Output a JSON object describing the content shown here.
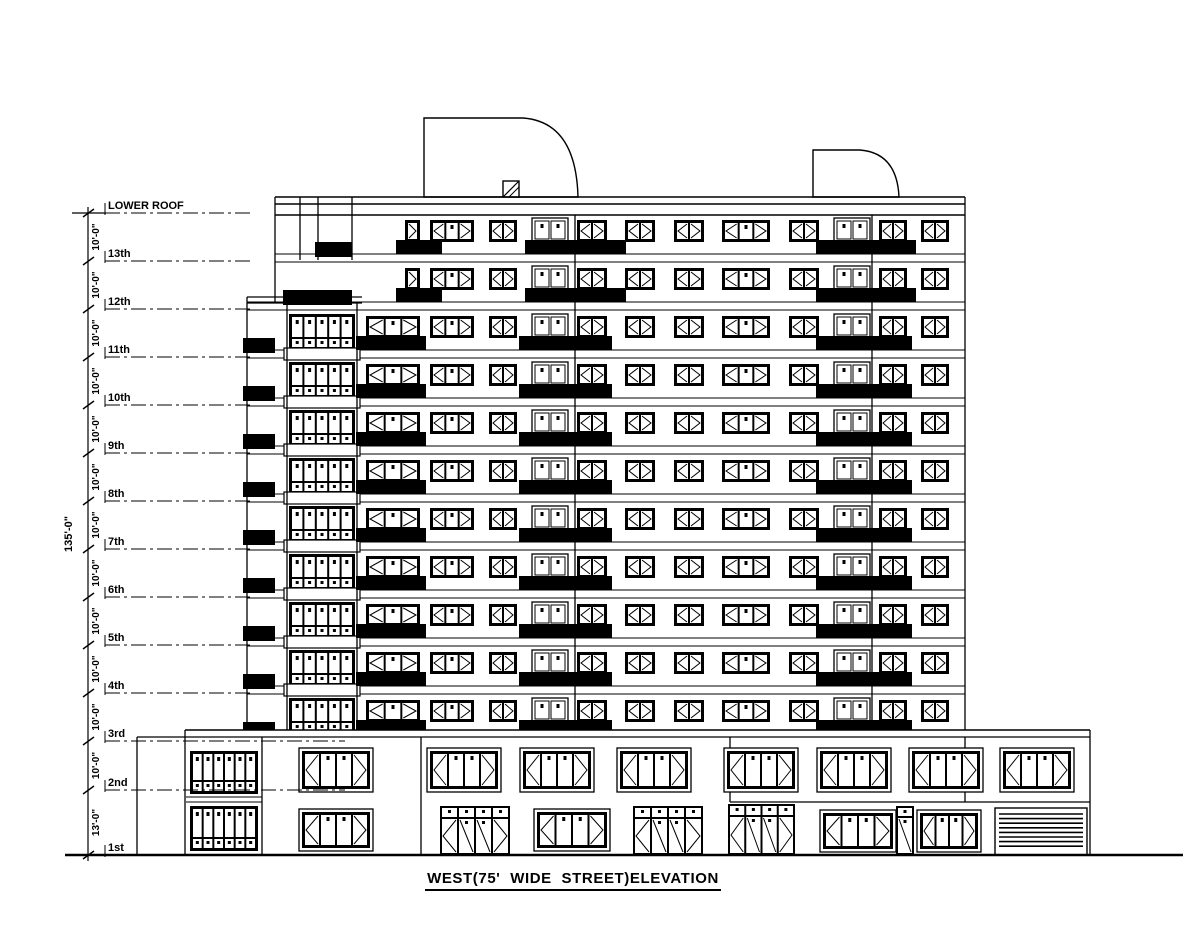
{
  "title": "WEST(75' WIDE  STREET)ELEVATION",
  "sheet": {
    "background": "#ffffff",
    "ink": "#000000",
    "width": 1200,
    "height": 927
  },
  "dimension_column": {
    "overall_dim": "135'-0\"",
    "typical_floor_dim": "10'-0\"",
    "ground_floor_dim": "13'-0\"",
    "dim_line_x": 88,
    "overall_label_pos": {
      "x": 72,
      "y": 534
    }
  },
  "floors": [
    {
      "label": "LOWER ROOF",
      "y": 213,
      "dim_below": "10'-0\"",
      "dash_end": 250
    },
    {
      "label": "13th",
      "y": 261,
      "dim_below": "10'-0\"",
      "dash_end": 250
    },
    {
      "label": "12th",
      "y": 309,
      "dim_below": "10'-0\"",
      "dash_end": 250
    },
    {
      "label": "11th",
      "y": 357,
      "dim_below": "10'-0\"",
      "dash_end": 250
    },
    {
      "label": "10th",
      "y": 405,
      "dim_below": "10'-0\"",
      "dash_end": 250
    },
    {
      "label": "9th",
      "y": 453,
      "dim_below": "10'-0\"",
      "dash_end": 250
    },
    {
      "label": "8th",
      "y": 501,
      "dim_below": "10'-0\"",
      "dash_end": 250
    },
    {
      "label": "7th",
      "y": 549,
      "dim_below": "10'-0\"",
      "dash_end": 250
    },
    {
      "label": "6th",
      "y": 597,
      "dim_below": "10'-0\"",
      "dash_end": 250
    },
    {
      "label": "5th",
      "y": 645,
      "dim_below": "10'-0\"",
      "dash_end": 250
    },
    {
      "label": "4th",
      "y": 693,
      "dim_below": "10'-0\"",
      "dash_end": 250
    },
    {
      "label": "3rd",
      "y": 741,
      "dim_below": "10'-0\"",
      "dash_end": 345
    },
    {
      "label": "2nd",
      "y": 790,
      "dim_below": "13'-0\"",
      "dash_end": 345
    },
    {
      "label": "1st",
      "y": 855,
      "dim_below": null,
      "dash_end": 135
    }
  ],
  "elevation": {
    "ground": {
      "y": 855,
      "x1": 65,
      "x2": 1183
    },
    "parapet": {
      "x1": 275,
      "x2": 965,
      "lines": [
        197,
        204,
        215
      ]
    },
    "bulkheads": [
      {
        "path": "M424,197 L424,118 L523,118 Q576,122 578,197 Z"
      },
      {
        "path": "M813,197 L813,150 L860,150 Q897,153 899,197 Z"
      }
    ],
    "roof_hatch": {
      "x": 503,
      "y": 181,
      "w": 16,
      "h": 16
    },
    "step_band": {
      "y1": 297,
      "y2": 303,
      "x1": 247,
      "x2": 362
    },
    "verticals": [
      [
        275,
        197,
        303
      ],
      [
        247,
        297,
        732
      ],
      [
        965,
        197,
        732
      ],
      [
        287,
        303,
        730
      ],
      [
        357,
        303,
        730
      ],
      [
        575,
        215,
        730
      ],
      [
        872,
        215,
        730
      ],
      [
        300,
        197,
        260
      ],
      [
        318,
        197,
        260
      ],
      [
        352,
        197,
        260
      ]
    ],
    "upper_floors": [
      261,
      309
    ],
    "typical_floors": [
      357,
      405,
      453,
      501,
      549,
      597,
      645,
      693,
      741
    ],
    "upper_columns": [
      {
        "t": "win",
        "x": 405,
        "w": 15,
        "p": [
          ">"
        ]
      },
      {
        "t": "win",
        "x": 430,
        "w": 44,
        "p": [
          "<",
          ".",
          ">"
        ]
      },
      {
        "t": "win",
        "x": 489,
        "w": 28,
        "p": [
          "<",
          ">"
        ]
      },
      {
        "t": "door",
        "x": 532,
        "w": 36
      },
      {
        "t": "win",
        "x": 577,
        "w": 30,
        "p": [
          "<",
          ">"
        ]
      },
      {
        "t": "win",
        "x": 625,
        "w": 30,
        "p": [
          "<",
          ">"
        ]
      },
      {
        "t": "win",
        "x": 674,
        "w": 30,
        "p": [
          "<",
          ">"
        ]
      },
      {
        "t": "win",
        "x": 722,
        "w": 48,
        "p": [
          "<",
          ".",
          ">"
        ]
      },
      {
        "t": "win",
        "x": 789,
        "w": 30,
        "p": [
          "<",
          ">"
        ]
      },
      {
        "t": "door",
        "x": 834,
        "w": 36
      },
      {
        "t": "win",
        "x": 879,
        "w": 28,
        "p": [
          "<",
          ">"
        ]
      },
      {
        "t": "win",
        "x": 921,
        "w": 28,
        "p": [
          "<",
          ">"
        ]
      }
    ],
    "upper_balconies": [
      [
        396,
        46
      ],
      [
        525,
        101
      ],
      [
        816,
        100
      ]
    ],
    "upper_wall_blacks": {
      "261": [
        [
          315,
          37
        ]
      ],
      "309": [
        [
          283,
          69
        ]
      ]
    },
    "typical_columns": [
      {
        "t": "black",
        "x": 243,
        "w": 32
      },
      {
        "t": "stack",
        "x": 289,
        "w": 66
      },
      {
        "t": "win",
        "x": 366,
        "w": 54,
        "p": [
          "<",
          ".",
          ">"
        ]
      },
      {
        "t": "win",
        "x": 430,
        "w": 44,
        "p": [
          "<",
          ".",
          ">"
        ]
      },
      {
        "t": "win",
        "x": 489,
        "w": 28,
        "p": [
          "<",
          ">"
        ]
      },
      {
        "t": "door",
        "x": 532,
        "w": 36
      },
      {
        "t": "win",
        "x": 577,
        "w": 30,
        "p": [
          "<",
          ">"
        ]
      },
      {
        "t": "win",
        "x": 625,
        "w": 30,
        "p": [
          "<",
          ">"
        ]
      },
      {
        "t": "win",
        "x": 674,
        "w": 30,
        "p": [
          "<",
          ">"
        ]
      },
      {
        "t": "win",
        "x": 722,
        "w": 48,
        "p": [
          "<",
          ".",
          ">"
        ]
      },
      {
        "t": "win",
        "x": 789,
        "w": 30,
        "p": [
          "<",
          ">"
        ]
      },
      {
        "t": "door",
        "x": 834,
        "w": 36
      },
      {
        "t": "win",
        "x": 879,
        "w": 28,
        "p": [
          "<",
          ">"
        ]
      },
      {
        "t": "win",
        "x": 921,
        "w": 28,
        "p": [
          "<",
          ">"
        ]
      }
    ],
    "typical_balconies": [
      [
        356,
        70
      ],
      [
        519,
        93
      ],
      [
        816,
        96
      ]
    ],
    "base": {
      "cover": {
        "x": 137,
        "y": 730,
        "w": 953,
        "h": 125
      },
      "top_line": {
        "y": 730,
        "x1": 185,
        "x2": 1090
      },
      "second_line": {
        "y": 737,
        "x1": 137,
        "x2": 1090
      },
      "step_line": {
        "y": 802,
        "x1": 730,
        "x2": 1090
      },
      "verticals": [
        [
          137,
          737,
          855
        ],
        [
          185,
          730,
          855
        ],
        [
          262,
          737,
          855
        ],
        [
          421,
          737,
          855
        ],
        [
          730,
          737,
          802
        ],
        [
          965,
          737,
          802
        ],
        [
          1090,
          730,
          855
        ]
      ],
      "bay_lines": [
        [
          186,
          797,
          262
        ],
        [
          186,
          802,
          262
        ]
      ],
      "stacked_units": [
        {
          "x": 190,
          "y": 751,
          "w": 68,
          "big": 26,
          "small": 9
        },
        {
          "x": 190,
          "y": 806,
          "w": 68,
          "big": 28,
          "small": 9
        }
      ],
      "second_floor_windows": {
        "xs": [
          302,
          430,
          523,
          620,
          727,
          820,
          912,
          1003
        ],
        "y": 751,
        "w": 68,
        "h": 38
      },
      "first_floor_units": [
        {
          "t": "win4",
          "x": 302,
          "y": 812,
          "w": 68,
          "h": 36
        },
        {
          "t": "door4",
          "x": 440,
          "y": 806,
          "w": 70,
          "h": 49
        },
        {
          "t": "win4",
          "x": 537,
          "y": 812,
          "w": 70,
          "h": 36
        },
        {
          "t": "door4",
          "x": 633,
          "y": 806,
          "w": 70,
          "h": 49
        },
        {
          "t": "door4",
          "x": 728,
          "y": 804,
          "w": 67,
          "h": 51
        },
        {
          "t": "win4",
          "x": 823,
          "y": 813,
          "w": 70,
          "h": 36
        },
        {
          "t": "door1",
          "x": 896,
          "y": 806,
          "w": 18,
          "h": 49
        },
        {
          "t": "win4",
          "x": 920,
          "y": 813,
          "w": 58,
          "h": 36
        },
        {
          "t": "garage",
          "x": 995,
          "y": 808,
          "w": 92,
          "h": 47
        }
      ]
    }
  }
}
